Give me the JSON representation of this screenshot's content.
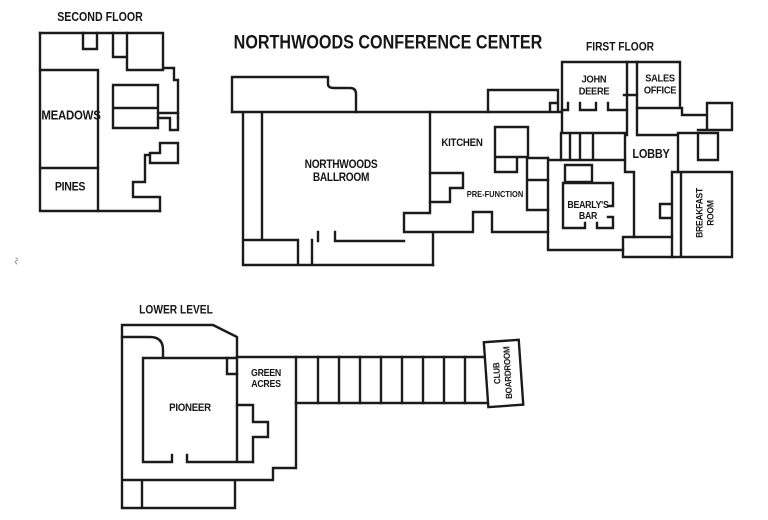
{
  "document": {
    "type": "floor-plan",
    "ink_color": "#1b1b1b",
    "background": "#ffffff"
  },
  "titles": {
    "main": "NORTHWOODS CONFERENCE CENTER",
    "second_floor": "SECOND FLOOR",
    "first_floor": "FIRST FLOOR",
    "lower_level": "LOWER LEVEL"
  },
  "rooms": {
    "second_floor": {
      "meadows": "MEADOWS",
      "pines": "PINES"
    },
    "first_floor": {
      "ballroom": "NORTHWOODS\nBALLROOM",
      "kitchen": "KITCHEN",
      "prefunction": "PRE-FUNCTION",
      "john_deere": "JOHN\nDEERE",
      "sales_office": "SALES\nOFFICE",
      "lobby": "LOBBY",
      "bearlys_bar": "BEARLY'S\nBAR",
      "breakfast_room": "BREAKFAST ROOM"
    },
    "lower_level": {
      "pioneer": "PIONEER",
      "green_acres": "GREEN\nACRES",
      "club_boardroom": "CLUB\nBOARDROOM"
    }
  }
}
